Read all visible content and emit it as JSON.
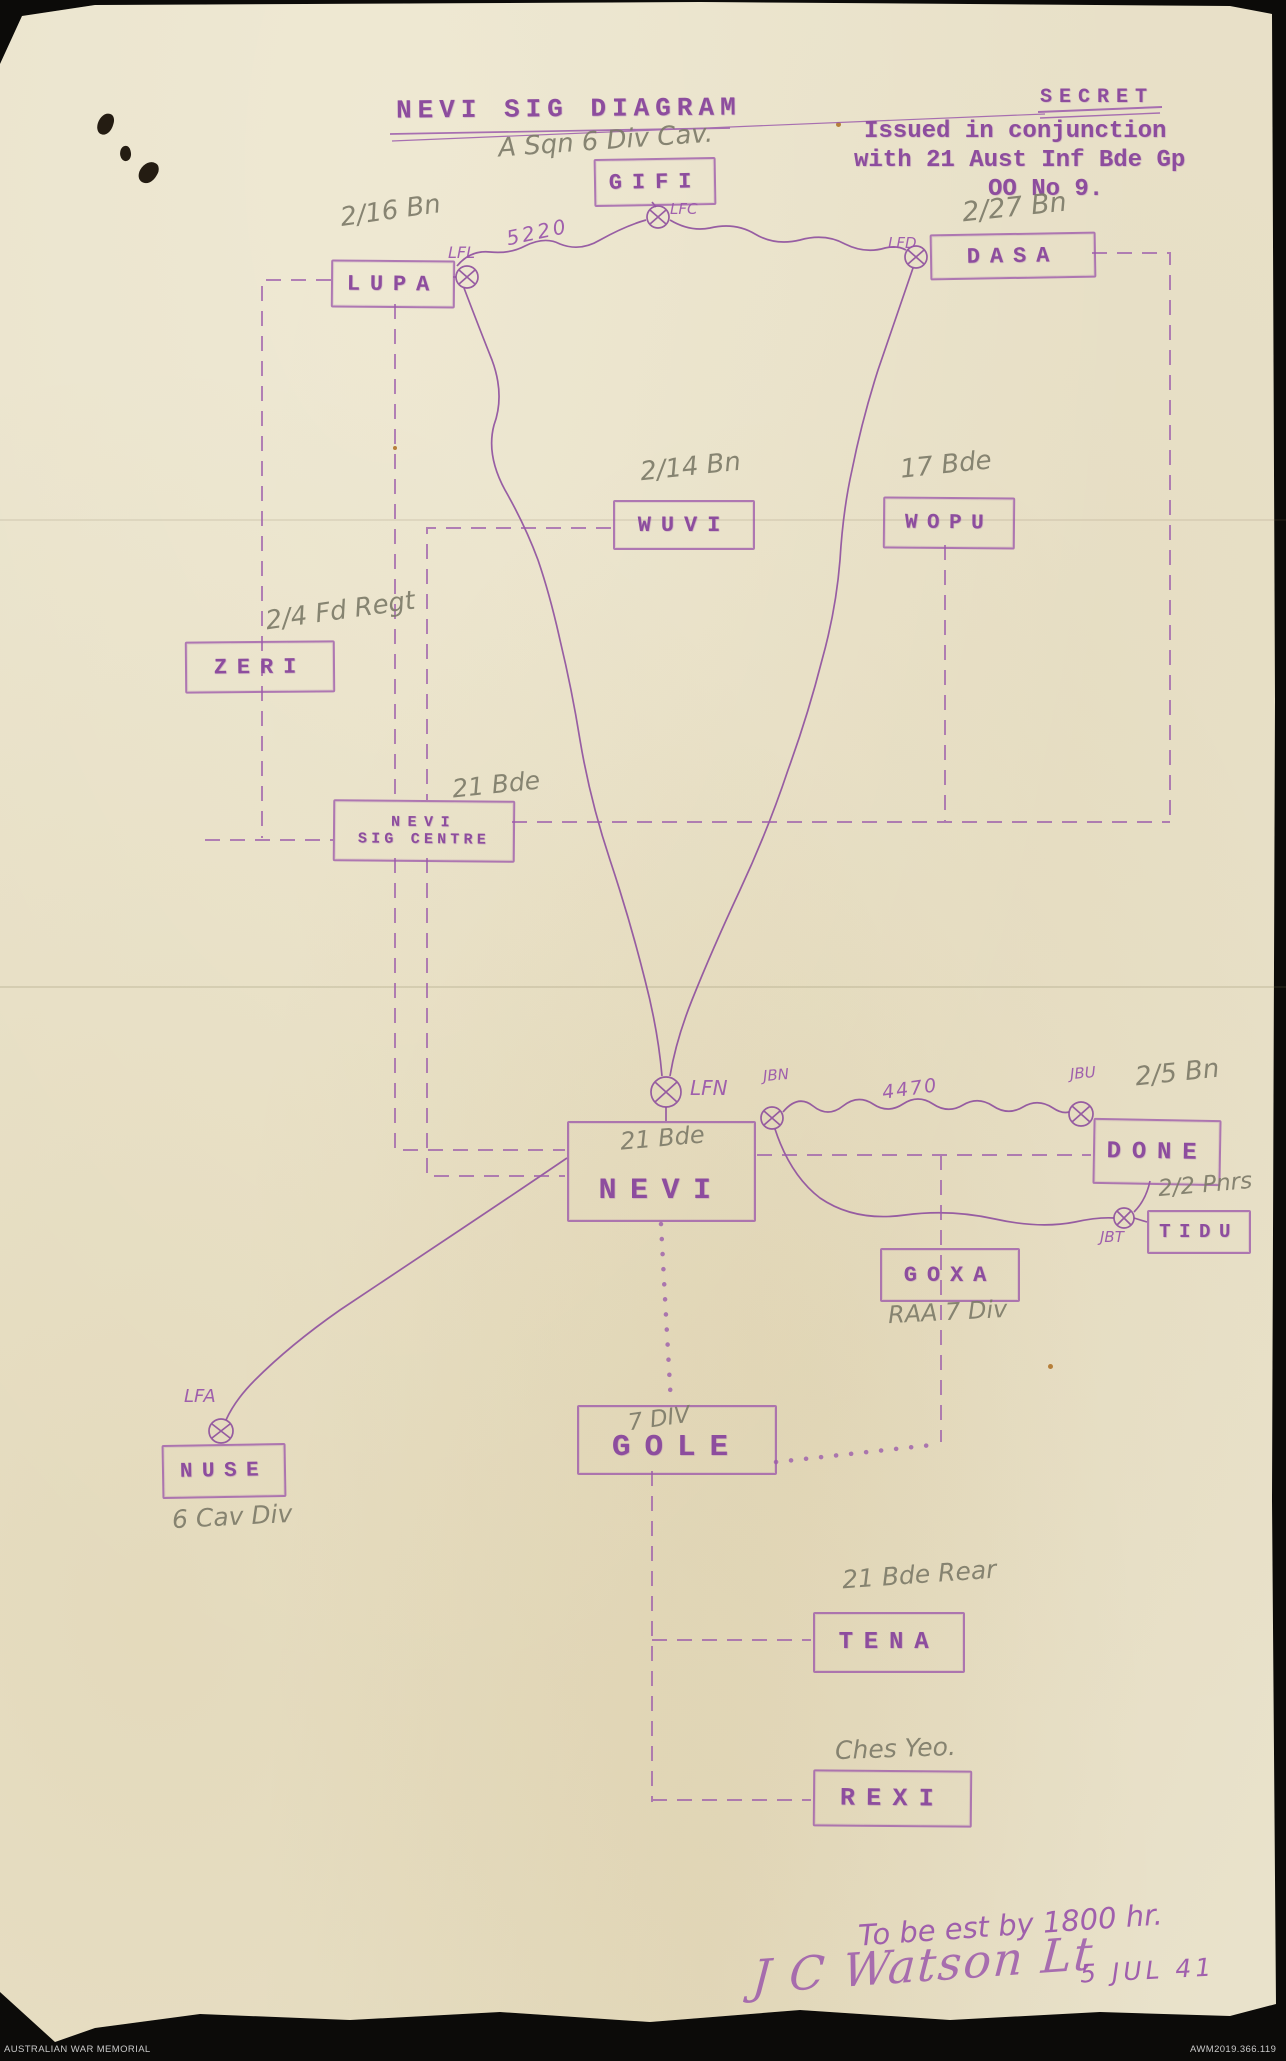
{
  "header": {
    "title": "NEVI SIG DIAGRAM",
    "classification": "SECRET",
    "issue_note_line1": "Issued in conjunction",
    "issue_note_line2": "with 21 Aust Inf Bde Gp",
    "issue_note_line3": "OO No 9."
  },
  "stations": [
    {
      "id": "gifi",
      "label": "GIFI",
      "annotation": "A Sqn 6 Div Cav."
    },
    {
      "id": "lupa",
      "label": "LUPA",
      "annotation": "2/16 Bn"
    },
    {
      "id": "dasa",
      "label": "DASA",
      "annotation": "2/27 Bn"
    },
    {
      "id": "wuvi",
      "label": "WUVI",
      "annotation": "2/14 Bn"
    },
    {
      "id": "wopu",
      "label": "WOPU",
      "annotation": "17 Bde"
    },
    {
      "id": "zeri",
      "label": "ZERI",
      "annotation": "2/4 Fd Regt"
    },
    {
      "id": "nevi-sig-centre",
      "line1": "NEVI",
      "line2": "SIG CENTRE",
      "annotation": "21 Bde"
    },
    {
      "id": "nevi",
      "label": "NEVI",
      "annotation": "21 Bde"
    },
    {
      "id": "done",
      "label": "DONE",
      "annotation": "2/5 Bn"
    },
    {
      "id": "tidu",
      "label": "TIDU",
      "annotation": "2/2 Pnrs"
    },
    {
      "id": "goxa",
      "label": "GOXA",
      "annotation": "RAA 7 Div"
    },
    {
      "id": "nuse",
      "label": "NUSE",
      "annotation": "6 Cav Div"
    },
    {
      "id": "gole",
      "label": "GOLE",
      "annotation": "7 DIV"
    },
    {
      "id": "tena",
      "label": "TENA",
      "annotation": "21 Bde Rear"
    },
    {
      "id": "rexi",
      "label": "REXI",
      "annotation": "Ches Yeo."
    }
  ],
  "line_labels": {
    "lfl": "LFL",
    "lfc": "LFC",
    "lfd": "LFD",
    "lfn": "LFN",
    "lfa": "LFA",
    "jbn": "JBN",
    "jbu": "JBU",
    "jbt": "JBT",
    "freq_top": "5220",
    "freq_right": "4470"
  },
  "footer": {
    "note": "To be est by 1800 hr.",
    "signature": "J C Watson Lt",
    "date": "5 JUL 41"
  },
  "archive_bar": {
    "institution": "AUSTRALIAN WAR MEMORIAL",
    "accession": "AWM2019.366.119"
  },
  "palette": {
    "ink": "#9a55ab",
    "pencil": "#7c7a68",
    "paper": "#e9e2cb",
    "background": "#0c0b09"
  }
}
